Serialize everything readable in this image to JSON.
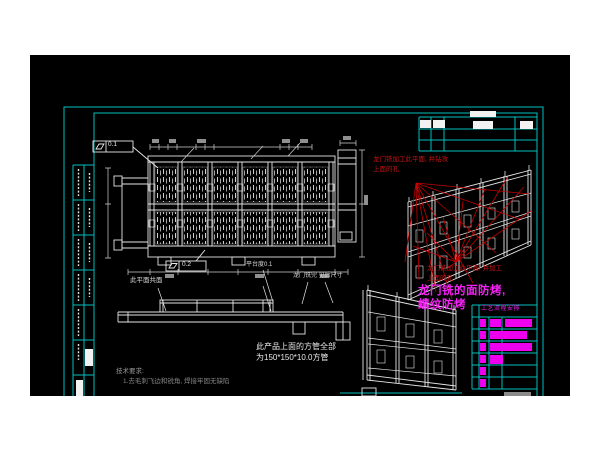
{
  "annotations": {
    "fcf_top_value": "0.1",
    "fcf_bottom_value": "0.2",
    "coplanar_label": "此平面共面",
    "platform_flatness_label": "平台度0.1",
    "mill_dim_label": "龙门铣完 见后尺寸",
    "tube_note_line1": "此产品上面的方管全部",
    "tube_note_line2": "为150*150*10.0方管",
    "red_note_top_line1": "龙门铣加工此平面, 并钻攻",
    "red_note_top_line2": "上面的孔",
    "red_note_mid_line1": "龙门铣加工此平面, 并加工",
    "red_note_mid_line2": "上面的孔",
    "magenta_note_line1": "龙门铣的面防烤,",
    "magenta_note_line2": "螺纹防烤",
    "tech_req_title": "技术要求:",
    "tech_req_item1": "1.去毛刺飞边和锐角, 焊接牢固无缺陷",
    "process_table_header": "工艺流程安排"
  },
  "colors": {
    "canvas_bg": "#000000",
    "frame_cyan": "#00bfbf",
    "line_white": "#e6e6e6",
    "annotation_red": "#c40000",
    "highlight_magenta": "#ff00ff",
    "dim_text_gray": "#9a9a9a"
  }
}
